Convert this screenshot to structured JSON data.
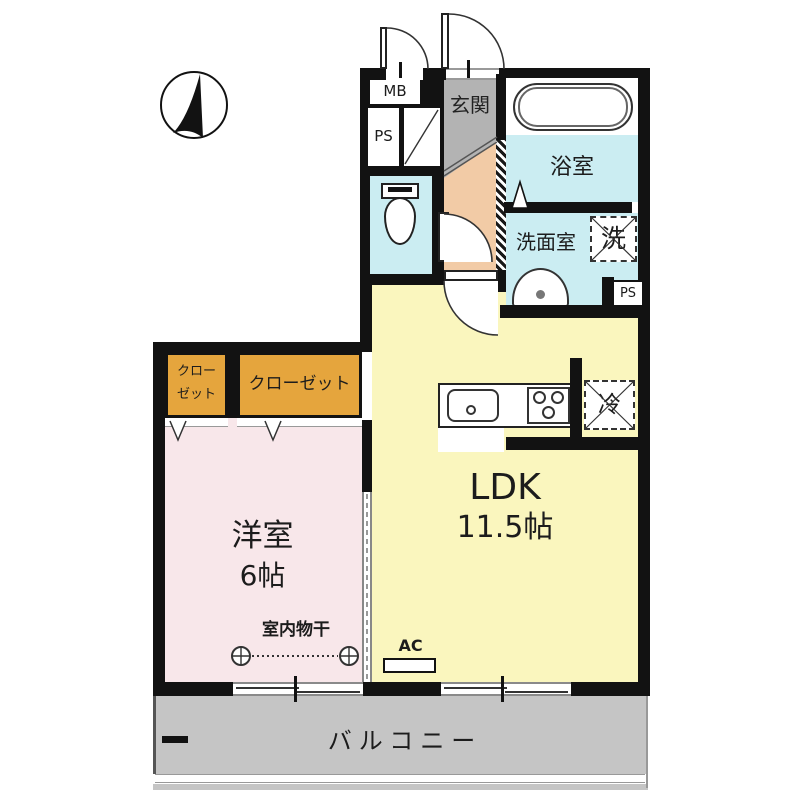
{
  "plan_type": "japanese-apartment-floor-plan",
  "labels": {
    "mb": "MB",
    "ps_top": "PS",
    "genkan": "玄関",
    "bathroom": "浴室",
    "washroom": "洗面室",
    "washer": "洗",
    "ps_side": "PS",
    "ldk_name": "LDK",
    "ldk_size": "11.5帖",
    "fridge": "冷",
    "closet_small_1": "クロー",
    "closet_small_2": "ゼット",
    "closet_large": "クローゼット",
    "bedroom_name": "洋室",
    "bedroom_size": "6帖",
    "laundry": "室内物干",
    "ac": "AC",
    "balcony": "バルコニー"
  },
  "colors": {
    "wall": "#121212",
    "ldk_floor": "#FAF6BE",
    "bedroom_floor": "#F8E7EA",
    "closet_fill": "#E5A53D",
    "genkan_floor": "#B3B3B3",
    "hall_floor": "#F2CBA6",
    "wet_room_floor": "#CBEDF2",
    "balcony_floor": "#C5C5C5"
  }
}
